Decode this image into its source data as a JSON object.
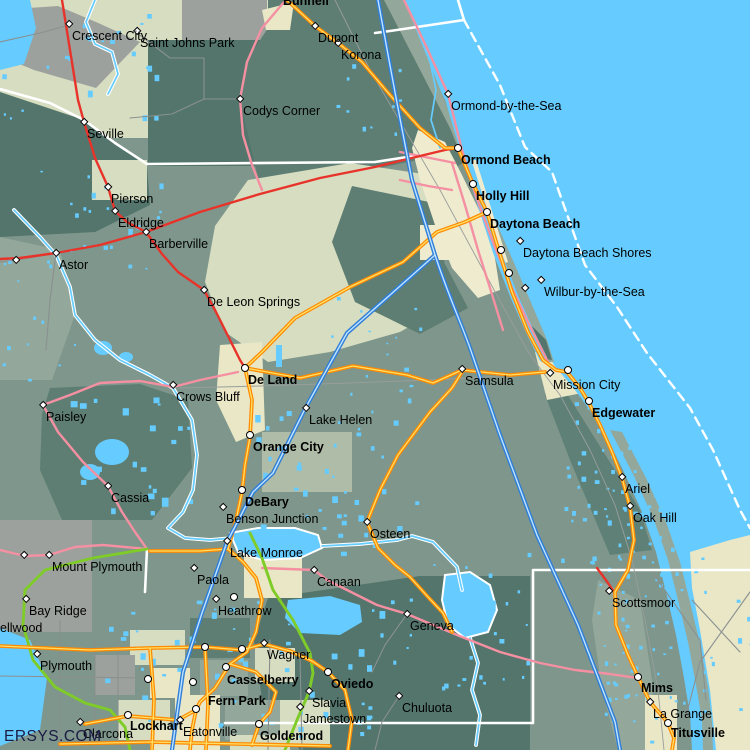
{
  "map": {
    "watermark": "ERSYS.COM",
    "colors": {
      "ocean": "#66CCFF",
      "water": "#66CCFF",
      "base": "#7E968B",
      "sage": "#D7DDC0",
      "cream": "#EFEBCF",
      "cream2": "#E9E7C6",
      "dark": "#53756C",
      "dark2": "#5E7E73",
      "gray": "#9CA19D",
      "gg": "#93A79A",
      "marsh": "#5E8076",
      "interstate": "#2F7ED8",
      "orange": "#FF8A00",
      "yellow": "#FFE066",
      "red": "#E8332A",
      "pink": "#F490A2",
      "green": "#7FCC28",
      "boundary": "#FFFFFF",
      "label": "#000000"
    },
    "cities": [
      {
        "name": "Crescent City",
        "x": 69,
        "y": 24,
        "m": "d"
      },
      {
        "name": "Saint Johns Park",
        "x": 137,
        "y": 31,
        "m": "d"
      },
      {
        "name": "Bunnell",
        "x": 283,
        "y": -5,
        "m": "n",
        "bold": 1,
        "dx": 0,
        "dy": 0
      },
      {
        "name": "Dupont",
        "x": 315,
        "y": 26,
        "m": "d"
      },
      {
        "name": "Korona",
        "x": 338,
        "y": 43,
        "m": "d"
      },
      {
        "name": "Codys Corner",
        "x": 240,
        "y": 99,
        "m": "d"
      },
      {
        "name": "Seville",
        "x": 84,
        "y": 122,
        "m": "d"
      },
      {
        "name": "Pierson",
        "x": 108,
        "y": 187,
        "m": "d"
      },
      {
        "name": "Eldridge",
        "x": 115,
        "y": 211,
        "m": "d"
      },
      {
        "name": "Barberville",
        "x": 146,
        "y": 232,
        "m": "d"
      },
      {
        "name": "Astor",
        "x": 56,
        "y": 253,
        "m": "d"
      },
      {
        "name": "De Leon Springs",
        "x": 204,
        "y": 290,
        "m": "d"
      },
      {
        "name": "Ormond-by-the-Sea",
        "x": 448,
        "y": 94,
        "m": "d"
      },
      {
        "name": "Ormond Beach",
        "x": 458,
        "y": 148,
        "m": "c",
        "bold": 1
      },
      {
        "name": "Holly Hill",
        "x": 473,
        "y": 184,
        "m": "c",
        "bold": 1
      },
      {
        "name": "Daytona Beach",
        "x": 487,
        "y": 212,
        "m": "c",
        "bold": 1
      },
      {
        "name": "Daytona Beach Shores",
        "x": 520,
        "y": 241,
        "m": "d"
      },
      {
        "name": "Wilbur-by-the-Sea",
        "x": 541,
        "y": 280,
        "m": "d"
      },
      {
        "name": "De Land",
        "x": 245,
        "y": 368,
        "m": "c",
        "bold": 1
      },
      {
        "name": "Crows Bluff",
        "x": 173,
        "y": 385,
        "m": "d"
      },
      {
        "name": "Lake Helen",
        "x": 306,
        "y": 408,
        "m": "d"
      },
      {
        "name": "Orange City",
        "x": 250,
        "y": 435,
        "m": "c",
        "bold": 1
      },
      {
        "name": "Samsula",
        "x": 462,
        "y": 369,
        "m": "d"
      },
      {
        "name": "Mission City",
        "x": 550,
        "y": 373,
        "m": "d"
      },
      {
        "name": "Edgewater",
        "x": 589,
        "y": 401,
        "m": "c",
        "bold": 1
      },
      {
        "name": "Paisley",
        "x": 43,
        "y": 405,
        "m": "d"
      },
      {
        "name": "Cassia",
        "x": 108,
        "y": 486,
        "m": "d"
      },
      {
        "name": "Ariel",
        "x": 622,
        "y": 477,
        "m": "d"
      },
      {
        "name": "Oak Hill",
        "x": 630,
        "y": 506,
        "m": "d"
      },
      {
        "name": "DeBary",
        "x": 242,
        "y": 490,
        "m": "c",
        "bold": 1
      },
      {
        "name": "Benson Junction",
        "x": 223,
        "y": 507,
        "m": "d"
      },
      {
        "name": "Osteen",
        "x": 367,
        "y": 522,
        "m": "d"
      },
      {
        "name": "Lake Monroe",
        "x": 227,
        "y": 541,
        "m": "d"
      },
      {
        "name": "Mount Plymouth",
        "x": 49,
        "y": 555,
        "m": "d"
      },
      {
        "name": "Paola",
        "x": 194,
        "y": 568,
        "m": "d"
      },
      {
        "name": "Canaan",
        "x": 314,
        "y": 570,
        "m": "d"
      },
      {
        "name": "Bay Ridge",
        "x": 26,
        "y": 599,
        "m": "d"
      },
      {
        "name": "Heathrow",
        "x": 234,
        "y": 597,
        "m": "c",
        "dx": -16,
        "dy": 8
      },
      {
        "name": "Scottsmoor",
        "x": 609,
        "y": 591,
        "m": "d"
      },
      {
        "name": "ellwood",
        "x": -2,
        "y": 620,
        "m": "n",
        "dx": 2,
        "dy": 2
      },
      {
        "name": "Plymouth",
        "x": 37,
        "y": 654,
        "m": "d"
      },
      {
        "name": "Geneva",
        "x": 407,
        "y": 614,
        "m": "d"
      },
      {
        "name": "Wagner",
        "x": 264,
        "y": 643,
        "m": "d"
      },
      {
        "name": "Oviedo",
        "x": 328,
        "y": 672,
        "m": "c",
        "bold": 1
      },
      {
        "name": "Casselberry",
        "x": 226,
        "y": 667,
        "m": "c",
        "bold": 1,
        "dx": 1,
        "dy": 7
      },
      {
        "name": "Slavia",
        "x": 309,
        "y": 691,
        "m": "d"
      },
      {
        "name": "Jamestown",
        "x": 300,
        "y": 707,
        "m": "d"
      },
      {
        "name": "Fern Park",
        "x": 196,
        "y": 709,
        "m": "c",
        "bold": 1,
        "dx": 12,
        "dy": -14
      },
      {
        "name": "Goldenrod",
        "x": 259,
        "y": 724,
        "m": "c",
        "bold": 1,
        "dx": 1,
        "dy": 6
      },
      {
        "name": "Eatonville",
        "x": 180,
        "y": 720,
        "m": "d"
      },
      {
        "name": "Lockhart",
        "x": 128,
        "y": 715,
        "m": "c",
        "bold": 1,
        "dx": 2,
        "dy": 5
      },
      {
        "name": "Clarcona",
        "x": 80,
        "y": 722,
        "m": "d"
      },
      {
        "name": "Chuluota",
        "x": 399,
        "y": 696,
        "m": "d"
      },
      {
        "name": "Mims",
        "x": 638,
        "y": 677,
        "m": "c",
        "bold": 1,
        "dx": 3,
        "dy": 5
      },
      {
        "name": "La Grange",
        "x": 650,
        "y": 702,
        "m": "d"
      },
      {
        "name": "Titusville",
        "x": 668,
        "y": 723,
        "m": "c",
        "bold": 1,
        "dx": 3,
        "dy": 4
      }
    ],
    "extra_markers": [
      {
        "x": 568,
        "y": 370,
        "m": "c"
      },
      {
        "x": 501,
        "y": 250,
        "m": "c"
      },
      {
        "x": 509,
        "y": 273,
        "m": "c"
      },
      {
        "x": 525,
        "y": 288,
        "m": "d"
      },
      {
        "x": 242,
        "y": 649,
        "m": "c"
      },
      {
        "x": 148,
        "y": 679,
        "m": "c"
      },
      {
        "x": 193,
        "y": 682,
        "m": "c"
      },
      {
        "x": 205,
        "y": 647,
        "m": "c"
      },
      {
        "x": 16,
        "y": 260,
        "m": "d"
      },
      {
        "x": 24,
        "y": 555,
        "m": "d"
      },
      {
        "x": 216,
        "y": 599,
        "m": "d"
      }
    ]
  }
}
